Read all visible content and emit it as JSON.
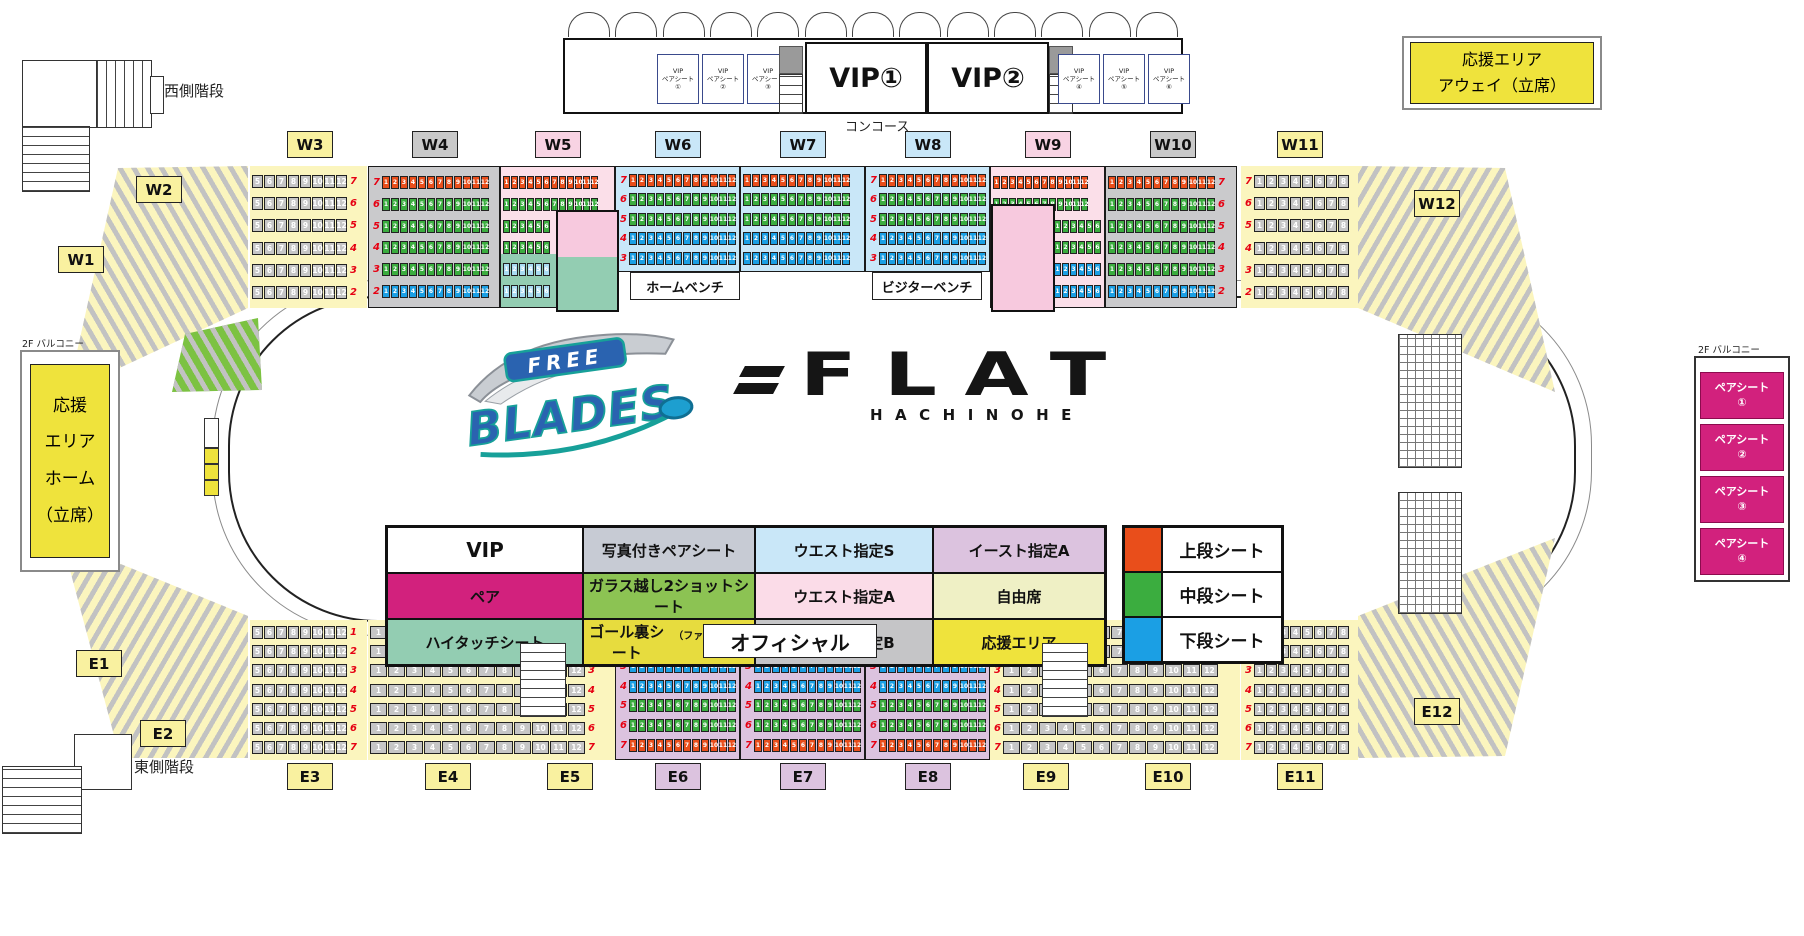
{
  "labels": {
    "west_stairs": "西側階段",
    "east_stairs": "東側階段",
    "concourse": "コンコース",
    "balcony_left": "2F バルコニー",
    "balcony_right": "2F バルコニー",
    "vip1": "VIP①",
    "vip2": "VIP②",
    "home_bench": "ホームベンチ",
    "visitor_bench": "ビジターベンチ",
    "official": "オフィシャル"
  },
  "away_area": {
    "line1": "応援エリア",
    "line2": "アウェイ（立席）"
  },
  "home_area": {
    "lines": [
      "応援",
      "エリア",
      "ホーム",
      "（立席）"
    ]
  },
  "vip_pair_boxes": [
    {
      "l1": "VIP",
      "l2": "ペアシート",
      "num": "①"
    },
    {
      "l1": "VIP",
      "l2": "ペアシート",
      "num": "②"
    },
    {
      "l1": "VIP",
      "l2": "ペアシート",
      "num": "③"
    },
    {
      "l1": "VIP",
      "l2": "ペアシート",
      "num": "④"
    },
    {
      "l1": "VIP",
      "l2": "ペアシート",
      "num": "⑤"
    },
    {
      "l1": "VIP",
      "l2": "ペアシート",
      "num": "⑥"
    }
  ],
  "pair_seats": [
    {
      "label": "ペアシート",
      "num": "①"
    },
    {
      "label": "ペアシート",
      "num": "②"
    },
    {
      "label": "ペアシート",
      "num": "③"
    },
    {
      "label": "ペアシート",
      "num": "④"
    }
  ],
  "logo": {
    "free": "FREE",
    "blades": "BLADES",
    "flat": "FLAT",
    "hachinohe": "HACHINOHE"
  },
  "legend": {
    "rows": [
      [
        {
          "label": "VIP",
          "bg": "#FFFFFF",
          "big": true
        },
        {
          "label": "写真付きペアシート",
          "bg": "#C7CBD4"
        },
        {
          "label": "ウエスト指定S",
          "bg": "#C9E7F8"
        },
        {
          "label": "イースト指定A",
          "bg": "#DCC3DF"
        }
      ],
      [
        {
          "label": "ペア",
          "bg": "#D2217D"
        },
        {
          "label": "ガラス越し2ショットシート",
          "bg": "#8CC353"
        },
        {
          "label": "ウエスト指定A",
          "bg": "#FBDCE8"
        },
        {
          "label": "自由席",
          "bg": "#EFF0C5"
        }
      ],
      [
        {
          "label": "ハイタッチシート",
          "bg": "#93CDB2"
        },
        {
          "label": "ゴール裏シート",
          "suffix": "（ファンクラブ限定）",
          "bg": "#E7DC3E"
        },
        {
          "label": "ウエスト指定B",
          "bg": "#C5C5C7"
        },
        {
          "label": "応援エリア",
          "bg": "#EFE33C"
        }
      ]
    ]
  },
  "tier_legend": [
    {
      "label": "上段シート",
      "color": "#E94E1B"
    },
    {
      "label": "中段シート",
      "color": "#3BAD3F"
    },
    {
      "label": "下段シート",
      "color": "#1B9FE4"
    }
  ],
  "seat_colors": {
    "o": "#E94E1B",
    "g": "#3BAD3F",
    "b": "#1B9FE4",
    "gy": "#C6C6C6",
    "lb": "#A9DCF2"
  },
  "section_labels": [
    {
      "id": "W1",
      "x": 58,
      "y": 246,
      "bg": "#F9F1A0"
    },
    {
      "id": "W2",
      "x": 136,
      "y": 176,
      "bg": "#F9F1A0"
    },
    {
      "id": "W3",
      "x": 287,
      "y": 131,
      "bg": "#F9F1A0"
    },
    {
      "id": "W4",
      "x": 412,
      "y": 131,
      "bg": "#C9C9C9"
    },
    {
      "id": "W5",
      "x": 535,
      "y": 131,
      "bg": "#F8D3E3"
    },
    {
      "id": "W6",
      "x": 655,
      "y": 131,
      "bg": "#C9E7F8"
    },
    {
      "id": "W7",
      "x": 780,
      "y": 131,
      "bg": "#C9E7F8"
    },
    {
      "id": "W8",
      "x": 905,
      "y": 131,
      "bg": "#C9E7F8"
    },
    {
      "id": "W9",
      "x": 1025,
      "y": 131,
      "bg": "#F8D3E3"
    },
    {
      "id": "W10",
      "x": 1150,
      "y": 131,
      "bg": "#C9C9C9"
    },
    {
      "id": "W11",
      "x": 1277,
      "y": 131,
      "bg": "#F9F1A0"
    },
    {
      "id": "W12",
      "x": 1414,
      "y": 190,
      "bg": "#F9F1A0"
    },
    {
      "id": "E1",
      "x": 76,
      "y": 650,
      "bg": "#F9F1A0"
    },
    {
      "id": "E2",
      "x": 140,
      "y": 720,
      "bg": "#F9F1A0"
    },
    {
      "id": "E3",
      "x": 287,
      "y": 763,
      "bg": "#F9F1A0"
    },
    {
      "id": "E4",
      "x": 425,
      "y": 763,
      "bg": "#F9F1A0"
    },
    {
      "id": "E5",
      "x": 547,
      "y": 763,
      "bg": "#F9F1A0"
    },
    {
      "id": "E6",
      "x": 655,
      "y": 763,
      "bg": "#DCC3DF"
    },
    {
      "id": "E7",
      "x": 780,
      "y": 763,
      "bg": "#DCC3DF"
    },
    {
      "id": "E8",
      "x": 905,
      "y": 763,
      "bg": "#DCC3DF"
    },
    {
      "id": "E9",
      "x": 1023,
      "y": 763,
      "bg": "#F9F1A0"
    },
    {
      "id": "E10",
      "x": 1145,
      "y": 763,
      "bg": "#F9F1A0"
    },
    {
      "id": "E11",
      "x": 1277,
      "y": 763,
      "bg": "#F9F1A0"
    },
    {
      "id": "E12",
      "x": 1414,
      "y": 698,
      "bg": "#F9F1A0"
    }
  ],
  "bg_rects": [
    {
      "x": 500,
      "y": 166,
      "w": 115,
      "h": 88,
      "bg": "#FBDFE9"
    },
    {
      "x": 500,
      "y": 254,
      "w": 115,
      "h": 54,
      "bg": "#93CDB2"
    },
    {
      "x": 990,
      "y": 166,
      "w": 115,
      "h": 142,
      "bg": "#FBDFE9"
    },
    {
      "x": 615,
      "y": 272,
      "w": 375,
      "h": 36,
      "bg": "#FFFFFF"
    }
  ],
  "wedges": [
    {
      "id": "top-left",
      "x": 60,
      "y": 160,
      "w": 190,
      "h": 235,
      "bg": "#FBF5BE",
      "ang": 60,
      "pts": [
        [
          188,
          6
        ],
        [
          188,
          148
        ],
        [
          8,
          232
        ],
        [
          58,
          8
        ]
      ]
    },
    {
      "id": "top-right",
      "x": 1358,
      "y": 160,
      "w": 205,
      "h": 235,
      "bg": "#FBF5BE",
      "ang": 300,
      "pts": [
        [
          0,
          6
        ],
        [
          147,
          8
        ],
        [
          197,
          232
        ],
        [
          0,
          148
        ]
      ]
    },
    {
      "id": "bottom-left",
      "x": 60,
      "y": 535,
      "w": 190,
      "h": 230,
      "bg": "#FBF5BE",
      "ang": 120,
      "pts": [
        [
          2,
          5
        ],
        [
          188,
          81
        ],
        [
          188,
          223
        ],
        [
          60,
          223
        ]
      ]
    },
    {
      "id": "bottom-right",
      "x": 1358,
      "y": 535,
      "w": 205,
      "h": 230,
      "bg": "#FBF5BE",
      "ang": 240,
      "pts": [
        [
          197,
          3
        ],
        [
          0,
          81
        ],
        [
          0,
          223
        ],
        [
          147,
          221
        ]
      ]
    },
    {
      "id": "green-patch",
      "x": 170,
      "y": 316,
      "w": 95,
      "h": 78,
      "bg": "#7CC242",
      "ang": 60,
      "pts": [
        [
          15,
          18
        ],
        [
          88,
          2
        ],
        [
          92,
          74
        ],
        [
          2,
          76
        ]
      ]
    }
  ],
  "seat_blocks": [
    {
      "id": "w3",
      "x": 250,
      "y": 166,
      "w": 117,
      "h": 142,
      "bg": "#FBF5BE",
      "ns": "right",
      "rows": [
        {
          "n": "7",
          "c": "gy",
          "s": 8,
          "st": 5
        },
        {
          "n": "6",
          "c": "gy",
          "s": 8,
          "st": 5
        },
        {
          "n": "5",
          "c": "gy",
          "s": 8,
          "st": 5
        },
        {
          "n": "4",
          "c": "gy",
          "s": 8,
          "st": 5
        },
        {
          "n": "3",
          "c": "gy",
          "s": 8,
          "st": 5
        },
        {
          "n": "2",
          "c": "gy",
          "s": 8,
          "st": 5
        }
      ]
    },
    {
      "id": "w4",
      "x": 368,
      "y": 166,
      "w": 132,
      "h": 142,
      "bg": "#CACACC",
      "bd": 1,
      "ns": "left",
      "rows": [
        {
          "n": "7",
          "c": "o",
          "s": 12
        },
        {
          "n": "6",
          "c": "g",
          "s": 12
        },
        {
          "n": "5",
          "c": "g",
          "s": 12
        },
        {
          "n": "4",
          "c": "g",
          "s": 12
        },
        {
          "n": "3",
          "c": "g",
          "s": 12
        },
        {
          "n": "2",
          "c": "b",
          "s": 12
        }
      ]
    },
    {
      "id": "w5",
      "x": 500,
      "y": 166,
      "w": 115,
      "h": 142,
      "bg": "transparent",
      "bd": 1,
      "ns": "none",
      "rows": [
        {
          "c": "o",
          "s": 12
        },
        {
          "c": "g",
          "s": 12
        },
        {
          "c": "g",
          "s": 6,
          "cb": 12
        },
        {
          "c": "g",
          "s": 6,
          "cb": 12
        },
        {
          "c": "lb",
          "s": 6,
          "cb": 12
        },
        {
          "c": "lb",
          "s": 6,
          "cb": 12
        }
      ]
    },
    {
      "id": "w6",
      "x": 615,
      "y": 166,
      "w": 125,
      "h": 106,
      "bg": "#C9E7F8",
      "bd": 1,
      "ns": "left",
      "rows": [
        {
          "n": "7",
          "c": "o",
          "s": 12
        },
        {
          "n": "6",
          "c": "g",
          "s": 12
        },
        {
          "n": "5",
          "c": "g",
          "s": 12
        },
        {
          "n": "4",
          "c": "b",
          "s": 12
        },
        {
          "n": "3",
          "c": "b",
          "s": 12
        }
      ]
    },
    {
      "id": "w7",
      "x": 740,
      "y": 166,
      "w": 125,
      "h": 106,
      "bg": "#C9E7F8",
      "bd": 1,
      "ns": "none",
      "rows": [
        {
          "c": "o",
          "s": 12
        },
        {
          "c": "g",
          "s": 12
        },
        {
          "c": "g",
          "s": 12
        },
        {
          "c": "b",
          "s": 12
        },
        {
          "c": "b",
          "s": 12
        }
      ]
    },
    {
      "id": "w8",
      "x": 865,
      "y": 166,
      "w": 125,
      "h": 106,
      "bg": "#C9E7F8",
      "bd": 1,
      "ns": "left",
      "rows": [
        {
          "n": "7",
          "c": "o",
          "s": 12
        },
        {
          "n": "6",
          "c": "g",
          "s": 12
        },
        {
          "n": "5",
          "c": "g",
          "s": 12
        },
        {
          "n": "4",
          "c": "b",
          "s": 12
        },
        {
          "n": "3",
          "c": "b",
          "s": 12
        }
      ]
    },
    {
      "id": "w9",
      "x": 990,
      "y": 166,
      "w": 115,
      "h": 142,
      "bg": "transparent",
      "bd": 1,
      "ns": "none",
      "rows": [
        {
          "c": "o",
          "s": 12
        },
        {
          "c": "g",
          "s": 12
        },
        {
          "c": "g",
          "s": 6,
          "cb": 12,
          "al": "right"
        },
        {
          "c": "g",
          "s": 6,
          "cb": 12,
          "al": "right"
        },
        {
          "c": "b",
          "s": 6,
          "cb": 12,
          "al": "right"
        },
        {
          "c": "b",
          "s": 6,
          "cb": 12,
          "al": "right"
        }
      ]
    },
    {
      "id": "w10",
      "x": 1105,
      "y": 166,
      "w": 132,
      "h": 142,
      "bg": "#CACACC",
      "bd": 1,
      "ns": "right",
      "rows": [
        {
          "n": "7",
          "c": "o",
          "s": 12
        },
        {
          "n": "6",
          "c": "g",
          "s": 12
        },
        {
          "n": "5",
          "c": "g",
          "s": 12
        },
        {
          "n": "4",
          "c": "g",
          "s": 12
        },
        {
          "n": "3",
          "c": "g",
          "s": 12
        },
        {
          "n": "2",
          "c": "b",
          "s": 12
        }
      ]
    },
    {
      "id": "w11",
      "x": 1241,
      "y": 166,
      "w": 117,
      "h": 142,
      "bg": "#FBF5BE",
      "ns": "left",
      "rows": [
        {
          "n": "7",
          "c": "gy",
          "s": 8,
          "st": 1
        },
        {
          "n": "6",
          "c": "gy",
          "s": 8,
          "st": 1
        },
        {
          "n": "5",
          "c": "gy",
          "s": 8,
          "st": 1
        },
        {
          "n": "4",
          "c": "gy",
          "s": 8,
          "st": 1
        },
        {
          "n": "3",
          "c": "gy",
          "s": 8,
          "st": 1
        },
        {
          "n": "2",
          "c": "gy",
          "s": 8,
          "st": 1
        }
      ]
    },
    {
      "id": "e3",
      "x": 250,
      "y": 620,
      "w": 117,
      "h": 140,
      "bg": "#FBF5BE",
      "ns": "right",
      "rows": [
        {
          "n": "1",
          "c": "gy",
          "s": 8,
          "st": 5
        },
        {
          "n": "2",
          "c": "gy",
          "s": 8,
          "st": 5
        },
        {
          "n": "3",
          "c": "gy",
          "s": 8,
          "st": 5
        },
        {
          "n": "4",
          "c": "gy",
          "s": 8,
          "st": 5
        },
        {
          "n": "5",
          "c": "gy",
          "s": 8,
          "st": 5
        },
        {
          "n": "6",
          "c": "gy",
          "s": 8,
          "st": 5
        },
        {
          "n": "7",
          "c": "gy",
          "s": 8,
          "st": 5
        }
      ]
    },
    {
      "id": "e4",
      "x": 368,
      "y": 620,
      "w": 247,
      "h": 140,
      "bg": "#FBF5BE",
      "ns": "right",
      "rows": [
        {
          "n": "1",
          "c": "gy",
          "s": 12
        },
        {
          "n": "2",
          "c": "gy",
          "s": 12
        },
        {
          "n": "3",
          "c": "gy",
          "s": 12
        },
        {
          "n": "4",
          "c": "gy",
          "s": 12
        },
        {
          "n": "5",
          "c": "gy",
          "s": 12
        },
        {
          "n": "6",
          "c": "gy",
          "s": 12
        },
        {
          "n": "7",
          "c": "gy",
          "s": 12
        }
      ]
    },
    {
      "id": "e6",
      "x": 615,
      "y": 652,
      "w": 125,
      "h": 108,
      "bg": "#DCC3DF",
      "bd": 1,
      "ns": "left",
      "rows": [
        {
          "n": "3",
          "c": "b",
          "s": 12
        },
        {
          "n": "4",
          "c": "b",
          "s": 12
        },
        {
          "n": "5",
          "c": "g",
          "s": 12
        },
        {
          "n": "6",
          "c": "g",
          "s": 12
        },
        {
          "n": "7",
          "c": "o",
          "s": 12
        }
      ]
    },
    {
      "id": "e7",
      "x": 740,
      "y": 652,
      "w": 125,
      "h": 108,
      "bg": "#DCC3DF",
      "bd": 1,
      "ns": "left",
      "rows": [
        {
          "n": "3",
          "c": "b",
          "s": 12
        },
        {
          "n": "4",
          "c": "b",
          "s": 12
        },
        {
          "n": "5",
          "c": "g",
          "s": 12
        },
        {
          "n": "6",
          "c": "g",
          "s": 12
        },
        {
          "n": "7",
          "c": "o",
          "s": 12
        }
      ]
    },
    {
      "id": "e8",
      "x": 865,
      "y": 652,
      "w": 125,
      "h": 108,
      "bg": "#DCC3DF",
      "bd": 1,
      "ns": "left",
      "rows": [
        {
          "n": "3",
          "c": "b",
          "s": 12
        },
        {
          "n": "4",
          "c": "b",
          "s": 12
        },
        {
          "n": "5",
          "c": "g",
          "s": 12
        },
        {
          "n": "6",
          "c": "g",
          "s": 12
        },
        {
          "n": "7",
          "c": "o",
          "s": 12
        }
      ]
    },
    {
      "id": "e9",
      "x": 990,
      "y": 620,
      "w": 250,
      "h": 140,
      "bg": "#FBF5BE",
      "ns": "left",
      "rows": [
        {
          "n": "1",
          "c": "gy",
          "s": 12
        },
        {
          "n": "2",
          "c": "gy",
          "s": 12
        },
        {
          "n": "3",
          "c": "gy",
          "s": 12
        },
        {
          "n": "4",
          "c": "gy",
          "s": 12
        },
        {
          "n": "5",
          "c": "gy",
          "s": 12
        },
        {
          "n": "6",
          "c": "gy",
          "s": 12
        },
        {
          "n": "7",
          "c": "gy",
          "s": 12
        }
      ]
    },
    {
      "id": "e11",
      "x": 1241,
      "y": 620,
      "w": 117,
      "h": 140,
      "bg": "#FBF5BE",
      "ns": "left",
      "rows": [
        {
          "n": "1",
          "c": "gy",
          "s": 8,
          "st": 1
        },
        {
          "n": "2",
          "c": "gy",
          "s": 8,
          "st": 1
        },
        {
          "n": "3",
          "c": "gy",
          "s": 8,
          "st": 1
        },
        {
          "n": "4",
          "c": "gy",
          "s": 8,
          "st": 1
        },
        {
          "n": "5",
          "c": "gy",
          "s": 8,
          "st": 1
        },
        {
          "n": "6",
          "c": "gy",
          "s": 8,
          "st": 1
        },
        {
          "n": "7",
          "c": "gy",
          "s": 8,
          "st": 1
        }
      ]
    }
  ],
  "rooms": [
    {
      "id": "glass-room-west",
      "x": 556,
      "y": 210,
      "w": 59,
      "h": 98,
      "split": true,
      "topBg": "#F7C9DE",
      "botBg": "#93CDB2"
    },
    {
      "id": "room-east-pink",
      "x": 991,
      "y": 204,
      "w": 60,
      "h": 104,
      "bg": "#F7C9DE"
    }
  ],
  "structures": [
    {
      "type": "box",
      "x": 22,
      "y": 60,
      "w": 74,
      "h": 66
    },
    {
      "type": "vstripes",
      "x": 96,
      "y": 60,
      "w": 54,
      "h": 66
    },
    {
      "type": "box",
      "x": 150,
      "y": 76,
      "w": 12,
      "h": 36
    },
    {
      "type": "hstripes",
      "x": 22,
      "y": 126,
      "w": 66,
      "h": 64
    },
    {
      "type": "box",
      "x": 74,
      "y": 734,
      "w": 56,
      "h": 54
    },
    {
      "type": "hstripes",
      "x": 2,
      "y": 766,
      "w": 78,
      "h": 66
    },
    {
      "type": "hstripes",
      "x": 520,
      "y": 643,
      "w": 44,
      "h": 72
    },
    {
      "type": "hstripes",
      "x": 1042,
      "y": 643,
      "w": 44,
      "h": 72
    },
    {
      "type": "cross",
      "x": 1398,
      "y": 334,
      "w": 62,
      "h": 132
    },
    {
      "type": "cross",
      "x": 1398,
      "y": 492,
      "w": 62,
      "h": 120
    }
  ]
}
